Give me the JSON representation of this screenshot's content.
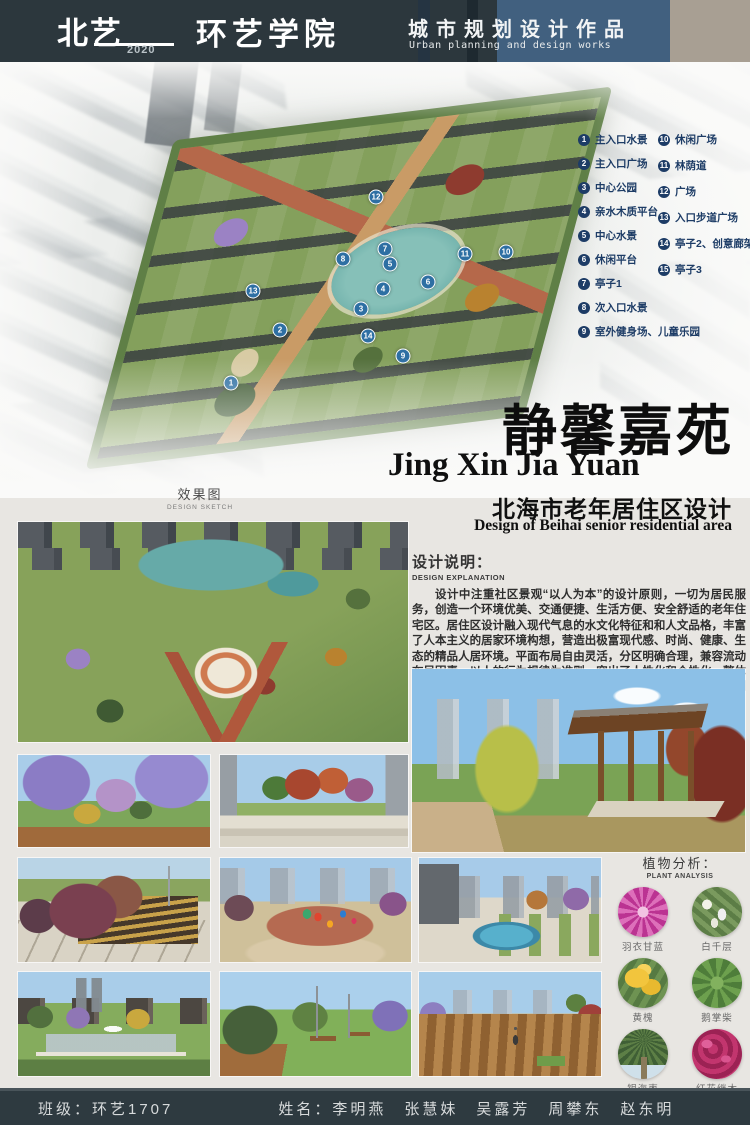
{
  "palette": {
    "header_bg": "#2c373d",
    "header_blue_panel": "#41607f",
    "header_tan_panel": "#a89f93",
    "legend_navy": "#1d3c66",
    "plan_marker_blue": "#2e6fa3",
    "footer_bg": "#2e3a40",
    "poster_bg": "#e8e6e2"
  },
  "header": {
    "logo_cn": "北艺",
    "logo_year": "2020",
    "logo_school": "环艺学院",
    "title_cn": "城市规划设计作品",
    "title_en": "Urban planning and design works"
  },
  "plan": {
    "markers": [
      "1",
      "2",
      "3",
      "4",
      "5",
      "6",
      "7",
      "8",
      "9",
      "10",
      "11",
      "12",
      "13",
      "14"
    ]
  },
  "legend": {
    "left": [
      {
        "num": "1",
        "label": "主入口水景"
      },
      {
        "num": "2",
        "label": "主入口广场"
      },
      {
        "num": "3",
        "label": "中心公园"
      },
      {
        "num": "4",
        "label": "亲水木质平台"
      },
      {
        "num": "5",
        "label": "中心水景"
      },
      {
        "num": "6",
        "label": "休闲平台"
      },
      {
        "num": "7",
        "label": "亭子1"
      },
      {
        "num": "8",
        "label": "次入口水景"
      },
      {
        "num": "9",
        "label": "室外健身场、儿童乐园"
      }
    ],
    "right": [
      {
        "num": "10",
        "label": "休闲广场"
      },
      {
        "num": "11",
        "label": "林荫道"
      },
      {
        "num": "12",
        "label": "广场"
      },
      {
        "num": "13",
        "label": "入口步道广场"
      },
      {
        "num": "14",
        "label": "亭子2、创意廊架"
      },
      {
        "num": "15",
        "label": "亭子3"
      }
    ]
  },
  "title_block": {
    "title_cn": "静馨嘉苑",
    "pinyin": "Jing Xin Jia Yuan",
    "subtitle_cn": "北海市老年居住区设计",
    "subtitle_en": "Design of Beihai senior residential area"
  },
  "sketch": {
    "cn": "效果图",
    "en": "DESIGN SKETCH"
  },
  "explanation": {
    "heading_cn": "设计说明：",
    "heading_en": "DESIGN EXPLANATION",
    "body": "设计中注重社区景观“以人为本”的设计原则，一切为居民服务，创造一个环境优美、交通便捷、生活方便、安全舒适的老年住宅区。居住区设计融入现代气息的水文化特征和和人文品格，丰富了人本主义的居家环境构想，营造出极富现代感、时尚、健康、生态的精品人居环境。平面布局自由灵活，分区明确合理，兼容流动布局因素，以人的行为规律为准则，突出了人性化和个性化。整体规划通过“轴心相连，绿脉对应”的景观布局分析，将社区环境规划为以中心水景为核心的向心式布局。"
  },
  "plants": {
    "heading_cn": "植物分析：",
    "heading_en": "PLANT ANALYSIS",
    "items": [
      {
        "name": "羽衣甘蓝"
      },
      {
        "name": "白千层"
      },
      {
        "name": "黄槐"
      },
      {
        "name": "鹅掌柴"
      },
      {
        "name": "银海枣"
      },
      {
        "name": "红花继木"
      }
    ]
  },
  "footer": {
    "class_text": "班级：环艺1707",
    "names_text": "姓名：李明燕　张慧妹　吴露芳　周攀东　赵东明"
  }
}
